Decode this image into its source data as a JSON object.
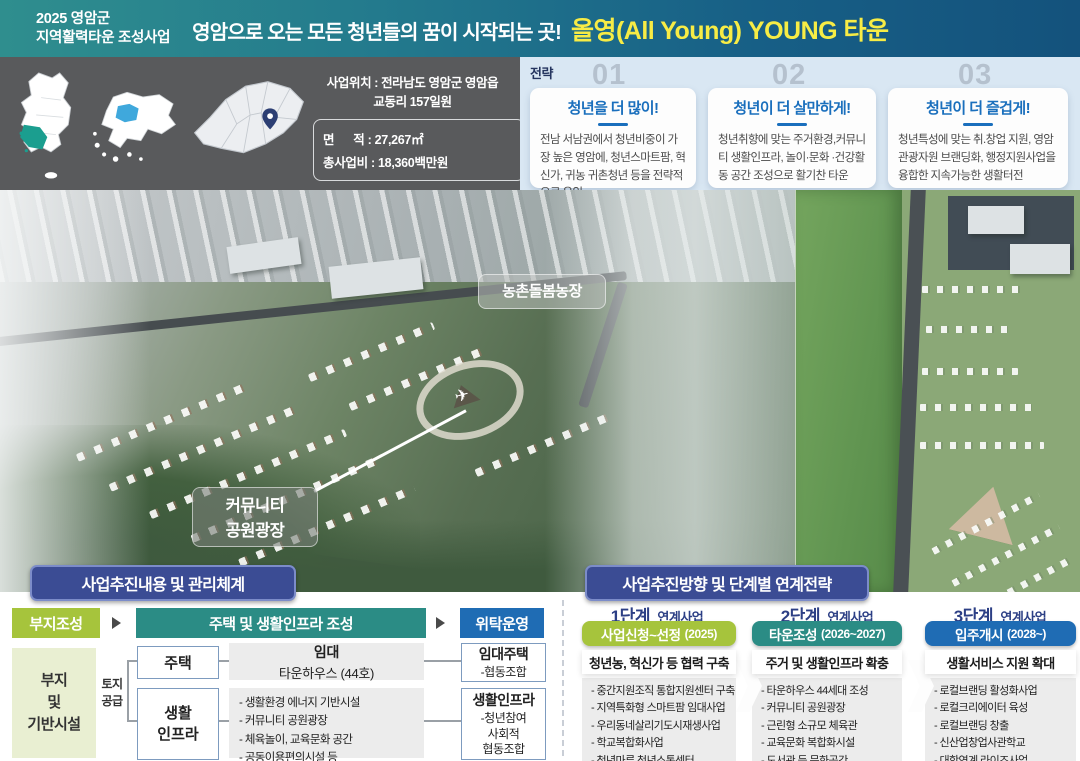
{
  "banner": {
    "program_line1": "2025 영암군",
    "program_line2": "지역활력타운 조성사업",
    "slogan": "영암으로 오는 모든 청년들의 꿈이 시작되는 곳!",
    "brand": "올영(All Young) YOUNG 타운"
  },
  "location": {
    "maps": [
      {
        "label": "전라남도"
      },
      {
        "label": "영암군"
      },
      {
        "label": "영암읍 교동리"
      }
    ],
    "site_line1": "사업위치 : 전라남도 영암군 영암읍",
    "site_line2": "교동리 157일원",
    "area_row": "면      적 : 27,267㎡",
    "budget_row": "총사업비 : 18,360백만원"
  },
  "strategy": {
    "label": "전략",
    "items": [
      {
        "number": "01",
        "title": "청년을 더 많이!",
        "body": "전남 서남권에서 청년비중이 가장 높은 영암에, 청년스마트팜, 혁신가, 귀농 귀촌청년 등을 전략적으로 유입"
      },
      {
        "number": "02",
        "title": "청년이 더 살만하게!",
        "body": "청년취향에 맞는 주거환경,커뮤니티 생활인프라, 놀이·문화 ·건강활동 공간 조성으로 활기찬 타운"
      },
      {
        "number": "03",
        "title": "청년이 더 즐겁게!",
        "body": "청년특성에 맞는 취.창업 지원, 영암 관광자원 브랜딩화, 행정지원사업을 융합한 지속가능한 생활터전"
      }
    ]
  },
  "render_labels": {
    "farm": "농촌돌봄농장",
    "plaza": "커뮤니티\n공원광장"
  },
  "management": {
    "title": "사업추진내용 및 관리체계",
    "step1": "부지조성",
    "step2": "주택 및 생활인프라 조성",
    "step3": "위탁운영",
    "site_box": "부지\n및\n기반시설",
    "supply_label": "토지\n공급",
    "housing_label": "주택",
    "infra_label": "생활\n인프라",
    "rental_title": "임대",
    "rental_sub": "타운하우스 (44호)",
    "infra_items": [
      "- 생활환경 에너지 기반시설",
      "- 커뮤니티 공원광장",
      "- 체육놀이, 교육문화 공간",
      "- 공동이용편의시설 등"
    ],
    "op1_title": "임대주택",
    "op1_sub": "-협동조합",
    "op2_title": "생활인프라",
    "op2_sub": "-청년참여\n사회적\n협동조합"
  },
  "roadmap": {
    "title": "사업추진방향 및 단계별 연계전략",
    "stages": [
      {
        "stage": "1단계",
        "tag": "연계사업",
        "bar": "사업신청~선정",
        "year": "(2025)",
        "subtitle": "청년농, 혁신가 등 협력 구축",
        "items": [
          "- 중간지원조직 통합지원센터 구축",
          "- 지역특화형 스마트팜 임대사업",
          "- 우리동네살리기도시재생사업",
          "- 학교복합화사업",
          "- 청년마루 청년소통센터"
        ]
      },
      {
        "stage": "2단계",
        "tag": "연계사업",
        "bar": "타운조성",
        "year": "(2026~2027)",
        "subtitle": "주거 및 생활인프라 확충",
        "items": [
          "- 타운하우스 44세대 조성",
          "- 커뮤니티 공원광장",
          "- 근린형 소규모 체육관",
          "- 교육문화 복합화시설",
          "- 도서관 등 문화공간"
        ]
      },
      {
        "stage": "3단계",
        "tag": "연계사업",
        "bar": "입주개시",
        "year": "(2028~)",
        "subtitle": "생활서비스 지원 확대",
        "items": [
          "- 로컬브랜딩 활성화사업",
          "- 로컬크리에이터 육성",
          "- 로컬브랜딩 창출",
          "- 신산업창업사관학교",
          "- 대학연계 라이즈사업"
        ]
      }
    ]
  },
  "colors": {
    "banner_teal": "#2f8e8e",
    "banner_blue": "#14527c",
    "brand_yellow": "#f7ec45",
    "strip_gray": "#595a5c",
    "strategy_bg": "#d9e7f3",
    "strategy_title_blue": "#1a6fbd",
    "header_navy": "#3b4c94",
    "stage1_green": "#a6c43c",
    "stage2_teal": "#2b8c85",
    "stage3_blue": "#1f6cb4",
    "jeonnam_teal": "#1b9e8f",
    "yeongam_blue": "#3fa8dc"
  }
}
